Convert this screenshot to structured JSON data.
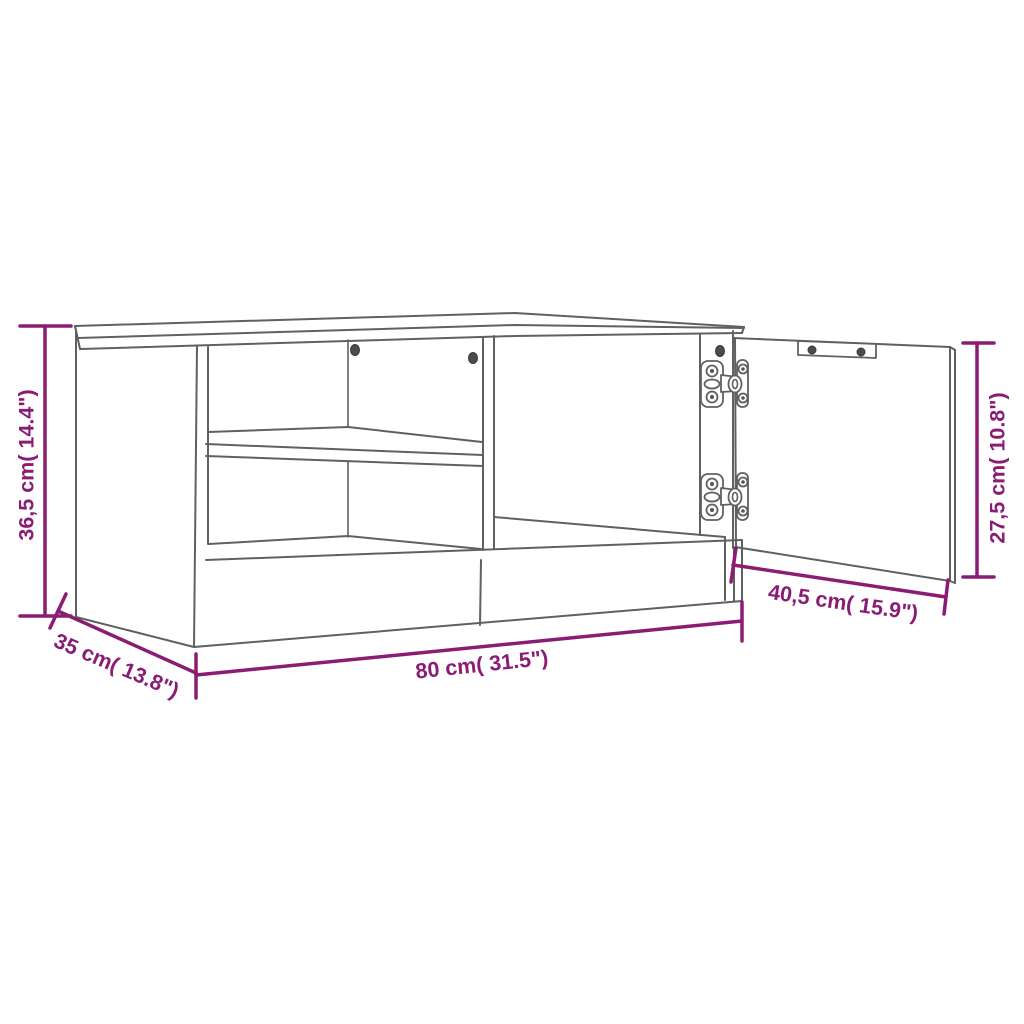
{
  "page": {
    "type": "product dimension diagram",
    "product": "TV cabinet wireframe with two open shelf compartments and one opened hinged door",
    "background": "#ffffff"
  },
  "style": {
    "line_color": "#606060",
    "dimension_color": "#8B1C74"
  },
  "dimensions": {
    "height": {
      "label": "36,5 cm( 14.4\")",
      "cm": "36,5",
      "inch": "14.4"
    },
    "depth": {
      "label": "35 cm( 13.8\")",
      "cm": "35",
      "inch": "13.8"
    },
    "width": {
      "label": "80 cm( 31.5\")",
      "cm": "80",
      "inch": "31.5"
    },
    "door_width": {
      "label": "40,5 cm( 15.9\")",
      "cm": "40,5",
      "inch": "15.9"
    },
    "door_height": {
      "label": "27,5 cm( 10.8\")",
      "cm": "27,5",
      "inch": "10.8"
    }
  }
}
